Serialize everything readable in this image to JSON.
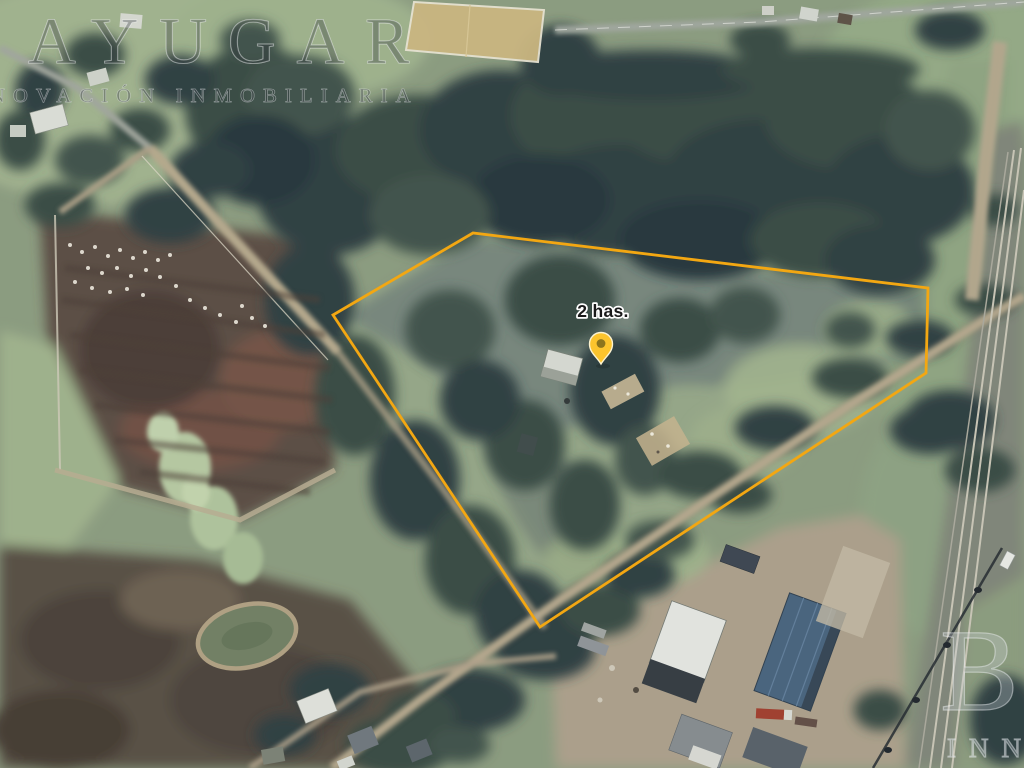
{
  "map": {
    "area_label": "2 has.",
    "colors": {
      "boundary": "#F3A712",
      "pin_body": "#FCC42D",
      "pin_dot": "#86701C",
      "pin_outline": "#FDF3D0"
    }
  },
  "watermarks": {
    "brand": "AYUGAR",
    "subtitle": "INNOVACIÓN INMOBILIARIA",
    "corner_letter": "B",
    "corner_text": "INN"
  }
}
